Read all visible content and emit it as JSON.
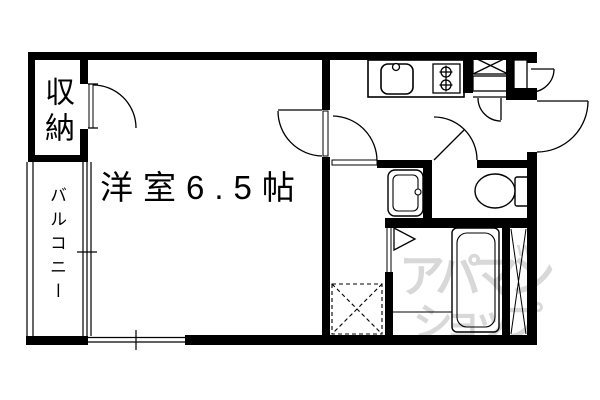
{
  "floor_plan": {
    "main_room_label": "洋室6.5帖",
    "closet_label": "収納",
    "balcony_label": "バルコニー"
  },
  "watermark": {
    "line1": "アパマン",
    "line2": "ショップ",
    "mark": "w",
    "dot": "°",
    "color": "#d8d8d8"
  },
  "style": {
    "wall_color": "#000000",
    "line_color": "#000000",
    "background": "#ffffff"
  },
  "fixtures": [
    "kitchen-sink",
    "gas-stove-2-burner",
    "shoe-cabinet",
    "meter-box",
    "entrance-door",
    "entrance-inner-door",
    "room-door",
    "closet-door",
    "washroom-door",
    "toilet-door",
    "toilet",
    "washbasin",
    "bathtub",
    "bath-folding-door",
    "washing-machine-space",
    "pipe-space",
    "balcony-window",
    "south-window"
  ]
}
